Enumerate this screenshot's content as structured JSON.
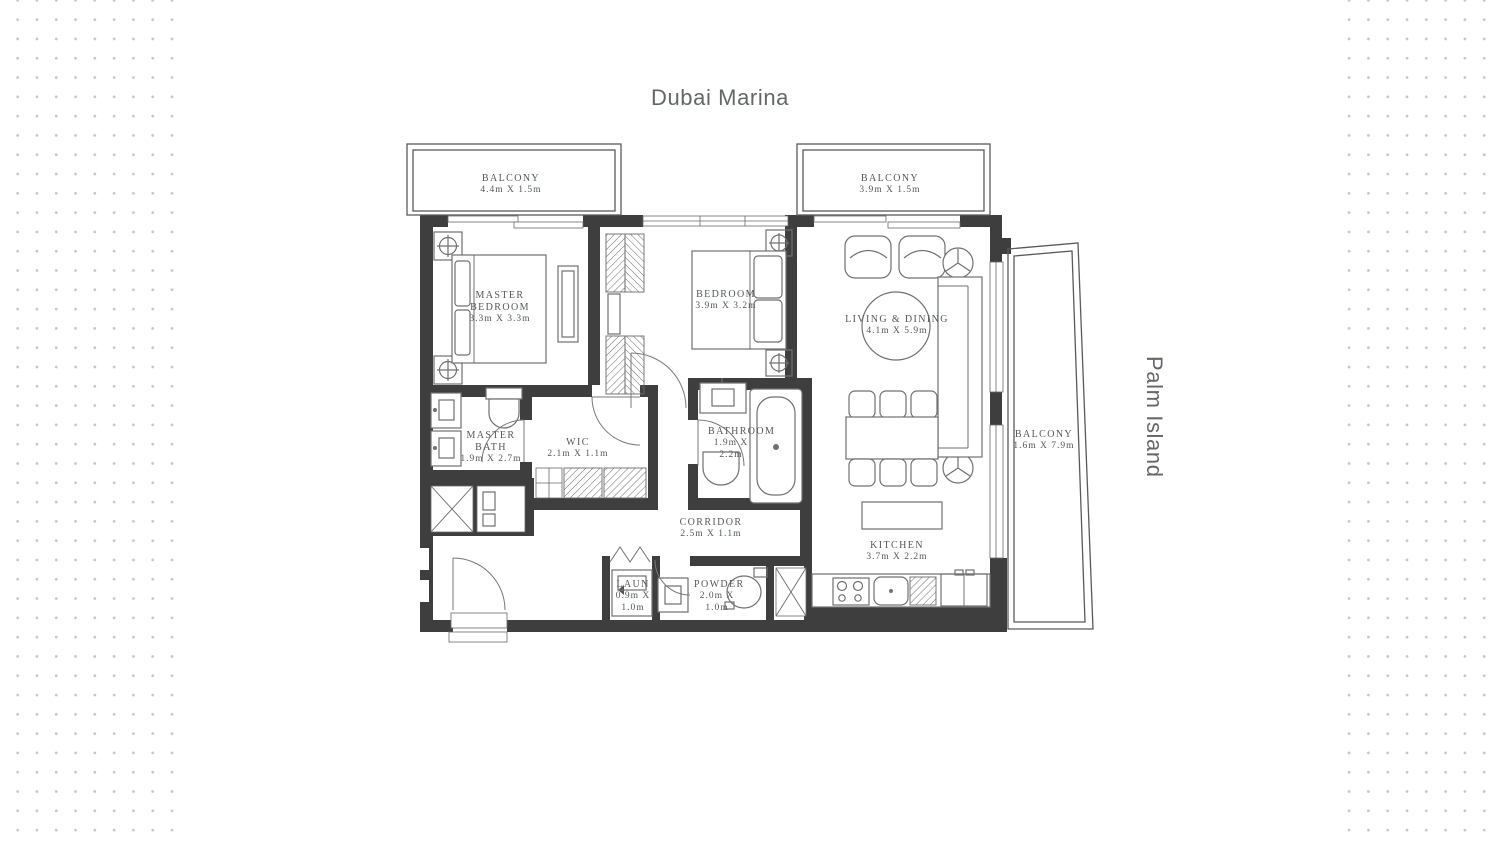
{
  "page": {
    "top_area_label": "Dubai Marina",
    "side_area_label": "Palm Island"
  },
  "colors": {
    "wall": "#3e3e3e",
    "furniture_line": "#707070",
    "room_text": "#54585a",
    "area_text": "#64676a",
    "dot": "#c6c6ca",
    "background": "#ffffff"
  },
  "rooms": [
    {
      "id": "balcony-top-left",
      "name": "BALCONY",
      "dims": "4.4m X 1.5m"
    },
    {
      "id": "balcony-top-right",
      "name": "BALCONY",
      "dims": "3.9m X 1.5m"
    },
    {
      "id": "master-bedroom",
      "name": "MASTER BEDROOM",
      "dims": "3.3m X 3.3m"
    },
    {
      "id": "bedroom",
      "name": "BEDROOM",
      "dims": "3.9m X 3.2m"
    },
    {
      "id": "living-dining",
      "name": "LIVING & DINING",
      "dims": "4.1m X 5.9m"
    },
    {
      "id": "master-bath",
      "name": "MASTER BATH",
      "dims": "1.9m X 2.7m"
    },
    {
      "id": "wic",
      "name": "WIC",
      "dims": "2.1m X 1.1m"
    },
    {
      "id": "bathroom",
      "name": "BATHROOM",
      "dims": "1.9m X 2.2m"
    },
    {
      "id": "corridor",
      "name": "CORRIDOR",
      "dims": "2.5m X 1.1m"
    },
    {
      "id": "kitchen",
      "name": "KITCHEN",
      "dims": "3.7m X 2.2m"
    },
    {
      "id": "laundry",
      "name": "LAUN",
      "dims": "0.9m X 1.0m"
    },
    {
      "id": "powder",
      "name": "POWDER",
      "dims": "2.0m X 1.0m"
    },
    {
      "id": "balcony-right",
      "name": "BALCONY",
      "dims": "1.6m X 7.9m"
    }
  ]
}
